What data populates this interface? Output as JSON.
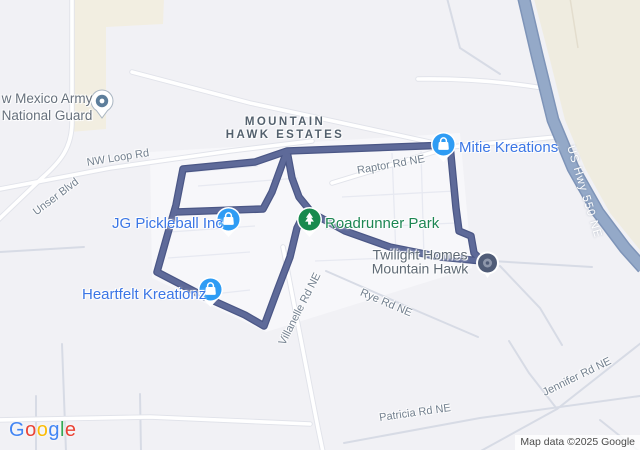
{
  "area_label": {
    "line1": "MOUNTAIN",
    "line2": "HAWK ESTATES"
  },
  "places": {
    "army_national_guard": {
      "line1": "w Mexico Army",
      "line2": "National Guard"
    },
    "mitie_kreations": {
      "name": "Mitie Kreations"
    },
    "jg_pickleball": {
      "name": "JG Pickleball Inc"
    },
    "roadrunner_park": {
      "name": "Roadrunner Park"
    },
    "heartfelt_kreationz": {
      "name": "Heartfelt Kreationz"
    },
    "twilight_homes": {
      "line1": "Twilight Homes",
      "line2": "Mountain Hawk"
    }
  },
  "road_labels": {
    "nw_loop_rd": "NW Loop Rd",
    "unser_blvd": "Unser Blvd",
    "raptor_rd": "Raptor Rd NE",
    "us_hwy_550": "US Hwy 550 NE",
    "villanelle_rd": "Villanelle Rd NE",
    "rye_rd": "Rye Rd NE",
    "jennifer_rd": "Jennifer Rd NE",
    "patricia_rd": "Patricia Rd NE"
  },
  "icons": {
    "shop_pin": "shopping-bag-pin-icon",
    "park_pin": "park-tree-pin-icon",
    "generic_pin": "place-dot-pin-icon",
    "destination": "destination-circle-icon"
  },
  "colors": {
    "route": "#5e6a99",
    "route_casing": "#4b5786",
    "poi_pin_blue": "#2e9cf4",
    "park_pin_green": "#188a4e",
    "poi_label_blue": "#3b76e5",
    "park_label_green": "#1d8653",
    "highway_fill": "#94a9c8",
    "beige_area": "#f2eee1",
    "map_background": "#f1f1f5"
  },
  "attribution": {
    "logo_letters": [
      "G",
      "o",
      "o",
      "g",
      "l",
      "e"
    ],
    "map_data": "Map data ©2025 Google"
  }
}
